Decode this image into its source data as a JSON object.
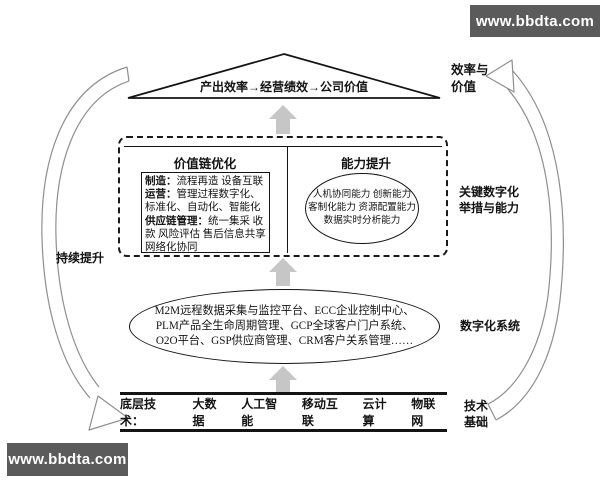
{
  "banners": {
    "top_right": "www.bbdta.com",
    "bottom_left": "www.bbdta.com"
  },
  "colors": {
    "banner_bg": "#5b5b5b",
    "banner_text": "#ffffff",
    "diagram_line": "#141414",
    "block_arrow": "#c6c6c6",
    "cycle_arrow": "#8f8f8f"
  },
  "triangle": {
    "label": "产出效率→经营绩效→公司价值"
  },
  "dashed_panel": {
    "value_chain": {
      "title": "价值链优化",
      "items": [
        {
          "label": "制造：",
          "text": "流程再造 设备互联"
        },
        {
          "label": "运营：",
          "text": "管理过程数字化、标准化、自动化、智能化"
        },
        {
          "label": "供应链管理：",
          "text": "统一集采 收款 风险评估 售后信息共享 网络化协同"
        }
      ]
    },
    "capability": {
      "title": "能力提升",
      "text": "人机协同能力 创新能力\n客制化能力 资源配置能力\n数据实时分析能力"
    }
  },
  "systems_ellipse": {
    "text": "M2M远程数据采集与监控平台、ECC企业控制中心、\nPLM产品全生命周期管理、GCP全球客户门户系统、\nO2O平台、GSP供应商管理、CRM客户关系管理……"
  },
  "base_bar": {
    "label": "底层技术：",
    "items": [
      "大数据",
      "人工智能",
      "移动互联",
      "云计算",
      "物联网"
    ]
  },
  "side_labels": {
    "left": "持续提升",
    "efficiency_value": "效率与\n价值",
    "key_digital": "关键数字化\n举措与能力",
    "digital_system": "数字化系统",
    "tech_base": "技术\n基础"
  }
}
